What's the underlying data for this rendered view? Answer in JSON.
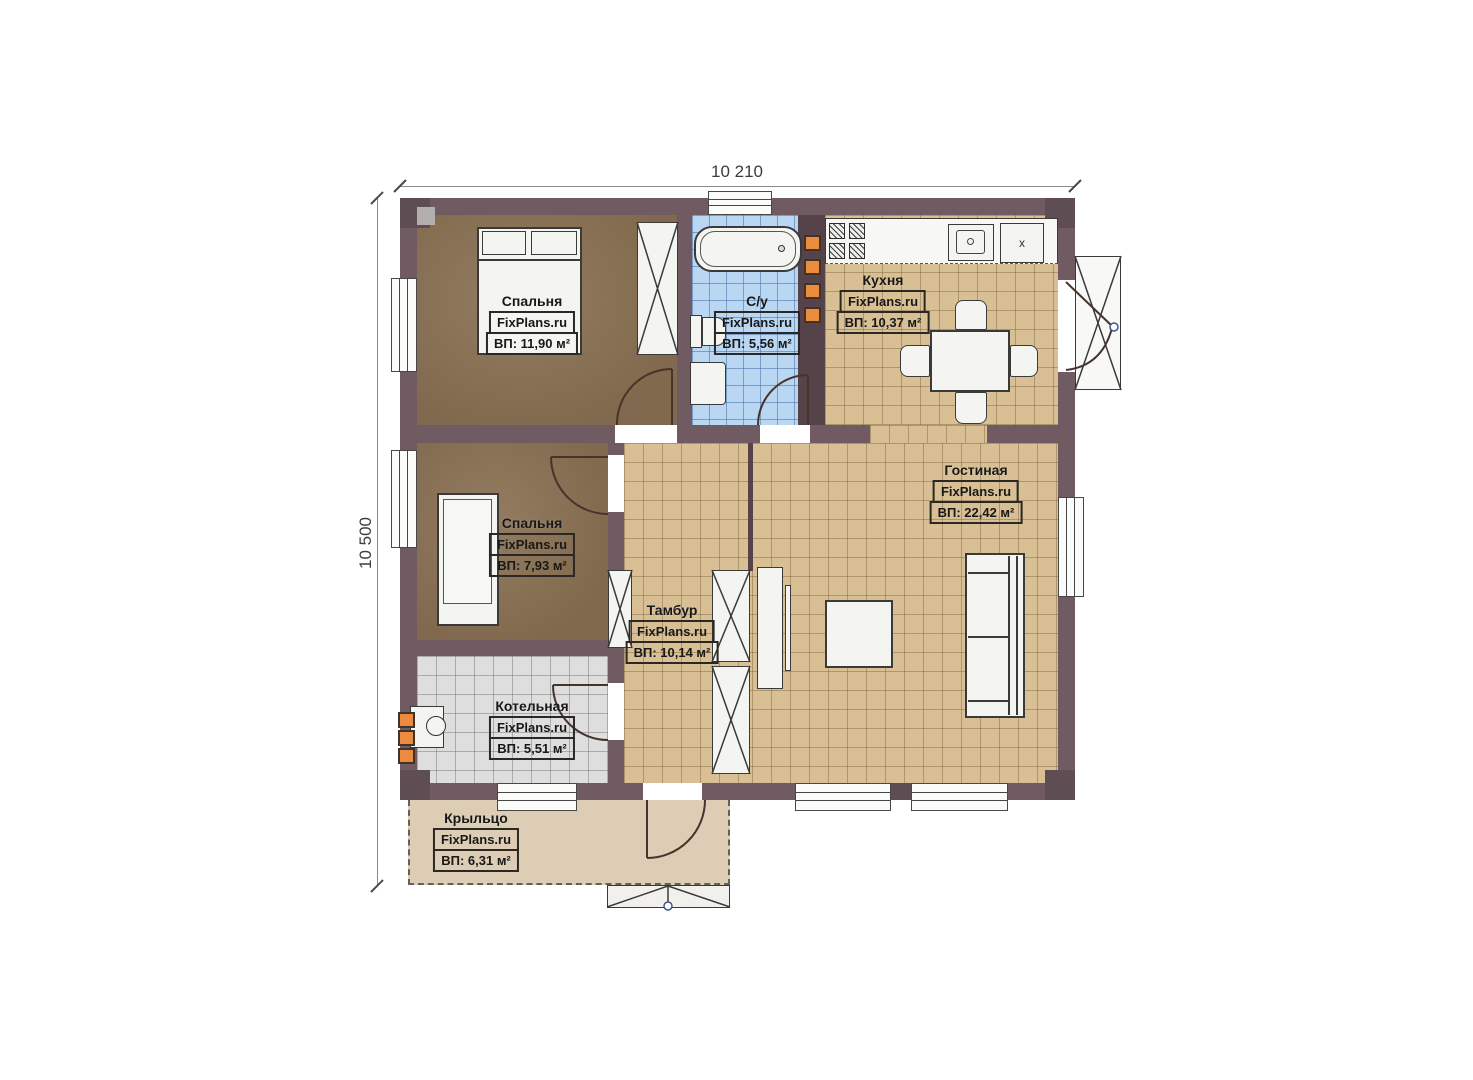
{
  "title": "House floor plan",
  "brand": "FixPlans.ru",
  "dimensions": {
    "width_label": "10 210",
    "height_label": "10 500"
  },
  "rooms": [
    {
      "name": "Спальня",
      "area": "ВП: 11,90 м²"
    },
    {
      "name": "С/у",
      "area": "ВП: 5,56 м²"
    },
    {
      "name": "Кухня",
      "area": "ВП: 10,37 м²"
    },
    {
      "name": "Гостиная",
      "area": "ВП: 22,42 м²"
    },
    {
      "name": "Спальня",
      "area": "ВП: 7,93 м²"
    },
    {
      "name": "Тамбур",
      "area": "ВП: 10,14 м²"
    },
    {
      "name": "Котельная",
      "area": "ВП: 5,51 м²"
    },
    {
      "name": "Крыльцо",
      "area": "ВП: 6,31 м²"
    }
  ],
  "kitchen": {
    "fridge_label": "x"
  },
  "colors": {
    "wall": "#6f5b61",
    "floor_wood": "#8b7254",
    "tile_tan": "#d8bf94",
    "tile_blue": "#b9d6f2",
    "tile_gray": "#dedede",
    "porch": "#dccdb4",
    "chimney_orange": "#ec8a3e"
  }
}
